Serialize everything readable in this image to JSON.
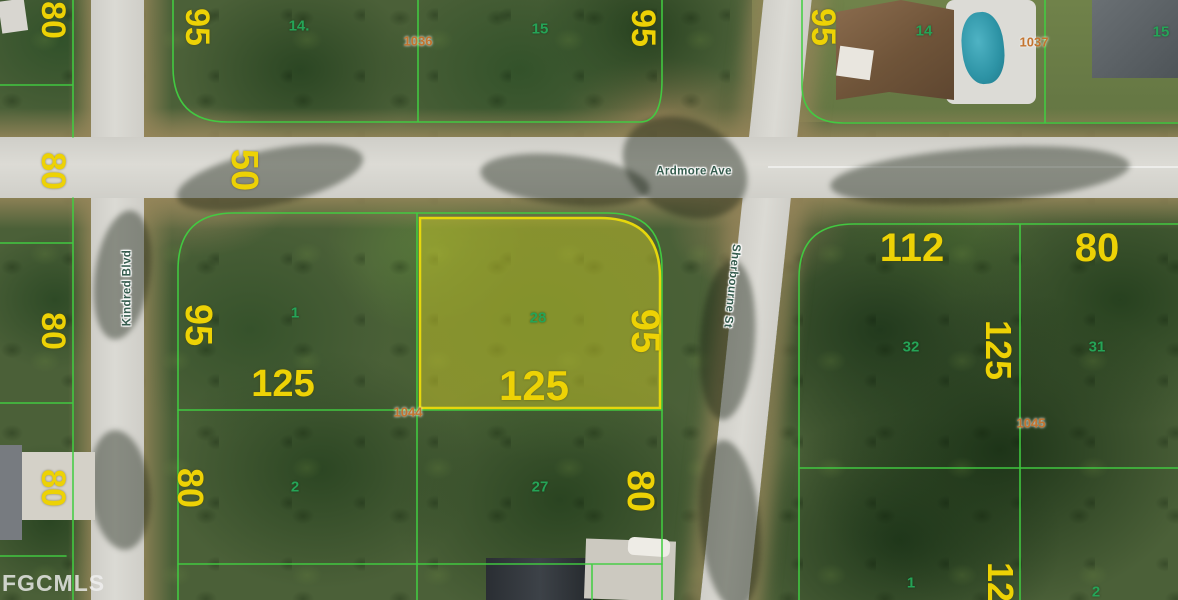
{
  "watermark": "FGCMLS",
  "streets": {
    "ardmore": {
      "label": "Ardmore Ave"
    },
    "kindred": {
      "label": "Kindred Blvd"
    },
    "sherbourne": {
      "label": "Sherbourne St"
    }
  },
  "highlighted_lot": "28",
  "map_labels": {
    "dimensions": [
      {
        "t": "80",
        "x": 53,
        "y": 20,
        "s": 34,
        "r": 90
      },
      {
        "t": "80",
        "x": 53,
        "y": 171,
        "s": 34,
        "r": 90
      },
      {
        "t": "80",
        "x": 53,
        "y": 331,
        "s": 34,
        "r": 90
      },
      {
        "t": "80",
        "x": 53,
        "y": 488,
        "s": 34,
        "r": 90
      },
      {
        "t": "95",
        "x": 197,
        "y": 27,
        "s": 34,
        "r": 90
      },
      {
        "t": "95",
        "x": 643,
        "y": 28,
        "s": 34,
        "r": 90
      },
      {
        "t": "95",
        "x": 823,
        "y": 27,
        "s": 34,
        "r": 90
      },
      {
        "t": "50",
        "x": 244,
        "y": 170,
        "s": 38,
        "r": 90
      },
      {
        "t": "95",
        "x": 198,
        "y": 325,
        "s": 38,
        "r": 90
      },
      {
        "t": "95",
        "x": 645,
        "y": 331,
        "s": 40,
        "r": 90
      },
      {
        "t": "125",
        "x": 283,
        "y": 384,
        "s": 38,
        "r": 0
      },
      {
        "t": "125",
        "x": 534,
        "y": 386,
        "s": 42,
        "r": 0
      },
      {
        "t": "80",
        "x": 190,
        "y": 488,
        "s": 36,
        "r": 90
      },
      {
        "t": "80",
        "x": 640,
        "y": 491,
        "s": 38,
        "r": 90
      },
      {
        "t": "112",
        "x": 912,
        "y": 248,
        "s": 40,
        "r": 0
      },
      {
        "t": "80",
        "x": 1097,
        "y": 248,
        "s": 40,
        "r": 0
      },
      {
        "t": "125",
        "x": 998,
        "y": 350,
        "s": 36,
        "r": 90
      },
      {
        "t": "125",
        "x": 1000,
        "y": 592,
        "s": 36,
        "r": 90
      }
    ],
    "lot_numbers": [
      {
        "t": "14.",
        "x": 299,
        "y": 26,
        "s": 15
      },
      {
        "t": "15",
        "x": 540,
        "y": 29,
        "s": 15
      },
      {
        "t": "14",
        "x": 924,
        "y": 31,
        "s": 15
      },
      {
        "t": "15",
        "x": 1161,
        "y": 32,
        "s": 15
      },
      {
        "t": "1",
        "x": 295,
        "y": 313,
        "s": 15
      },
      {
        "t": "28",
        "x": 538,
        "y": 318,
        "s": 15
      },
      {
        "t": "32",
        "x": 911,
        "y": 347,
        "s": 15
      },
      {
        "t": "31",
        "x": 1097,
        "y": 347,
        "s": 15
      },
      {
        "t": "2",
        "x": 295,
        "y": 487,
        "s": 15
      },
      {
        "t": "27",
        "x": 540,
        "y": 487,
        "s": 15
      },
      {
        "t": "1",
        "x": 911,
        "y": 583,
        "s": 15
      },
      {
        "t": "2",
        "x": 1096,
        "y": 592,
        "s": 15
      }
    ],
    "parcel_ids": [
      {
        "t": "1036",
        "x": 418,
        "y": 41,
        "s": 13
      },
      {
        "t": "1037",
        "x": 1034,
        "y": 42,
        "s": 13
      },
      {
        "t": "1044",
        "x": 408,
        "y": 412,
        "s": 13
      },
      {
        "t": "1045",
        "x": 1031,
        "y": 423,
        "s": 13
      }
    ]
  },
  "colors": {
    "dimension_text": "#edd205",
    "lot_number_text": "#25a457",
    "parcel_id_text": "#c4742f",
    "street_text": "#355c4e",
    "parcel_line": "#41cd41",
    "highlight_fill": "rgba(213,206,40,0.45)",
    "highlight_stroke": "#e6d70c"
  }
}
